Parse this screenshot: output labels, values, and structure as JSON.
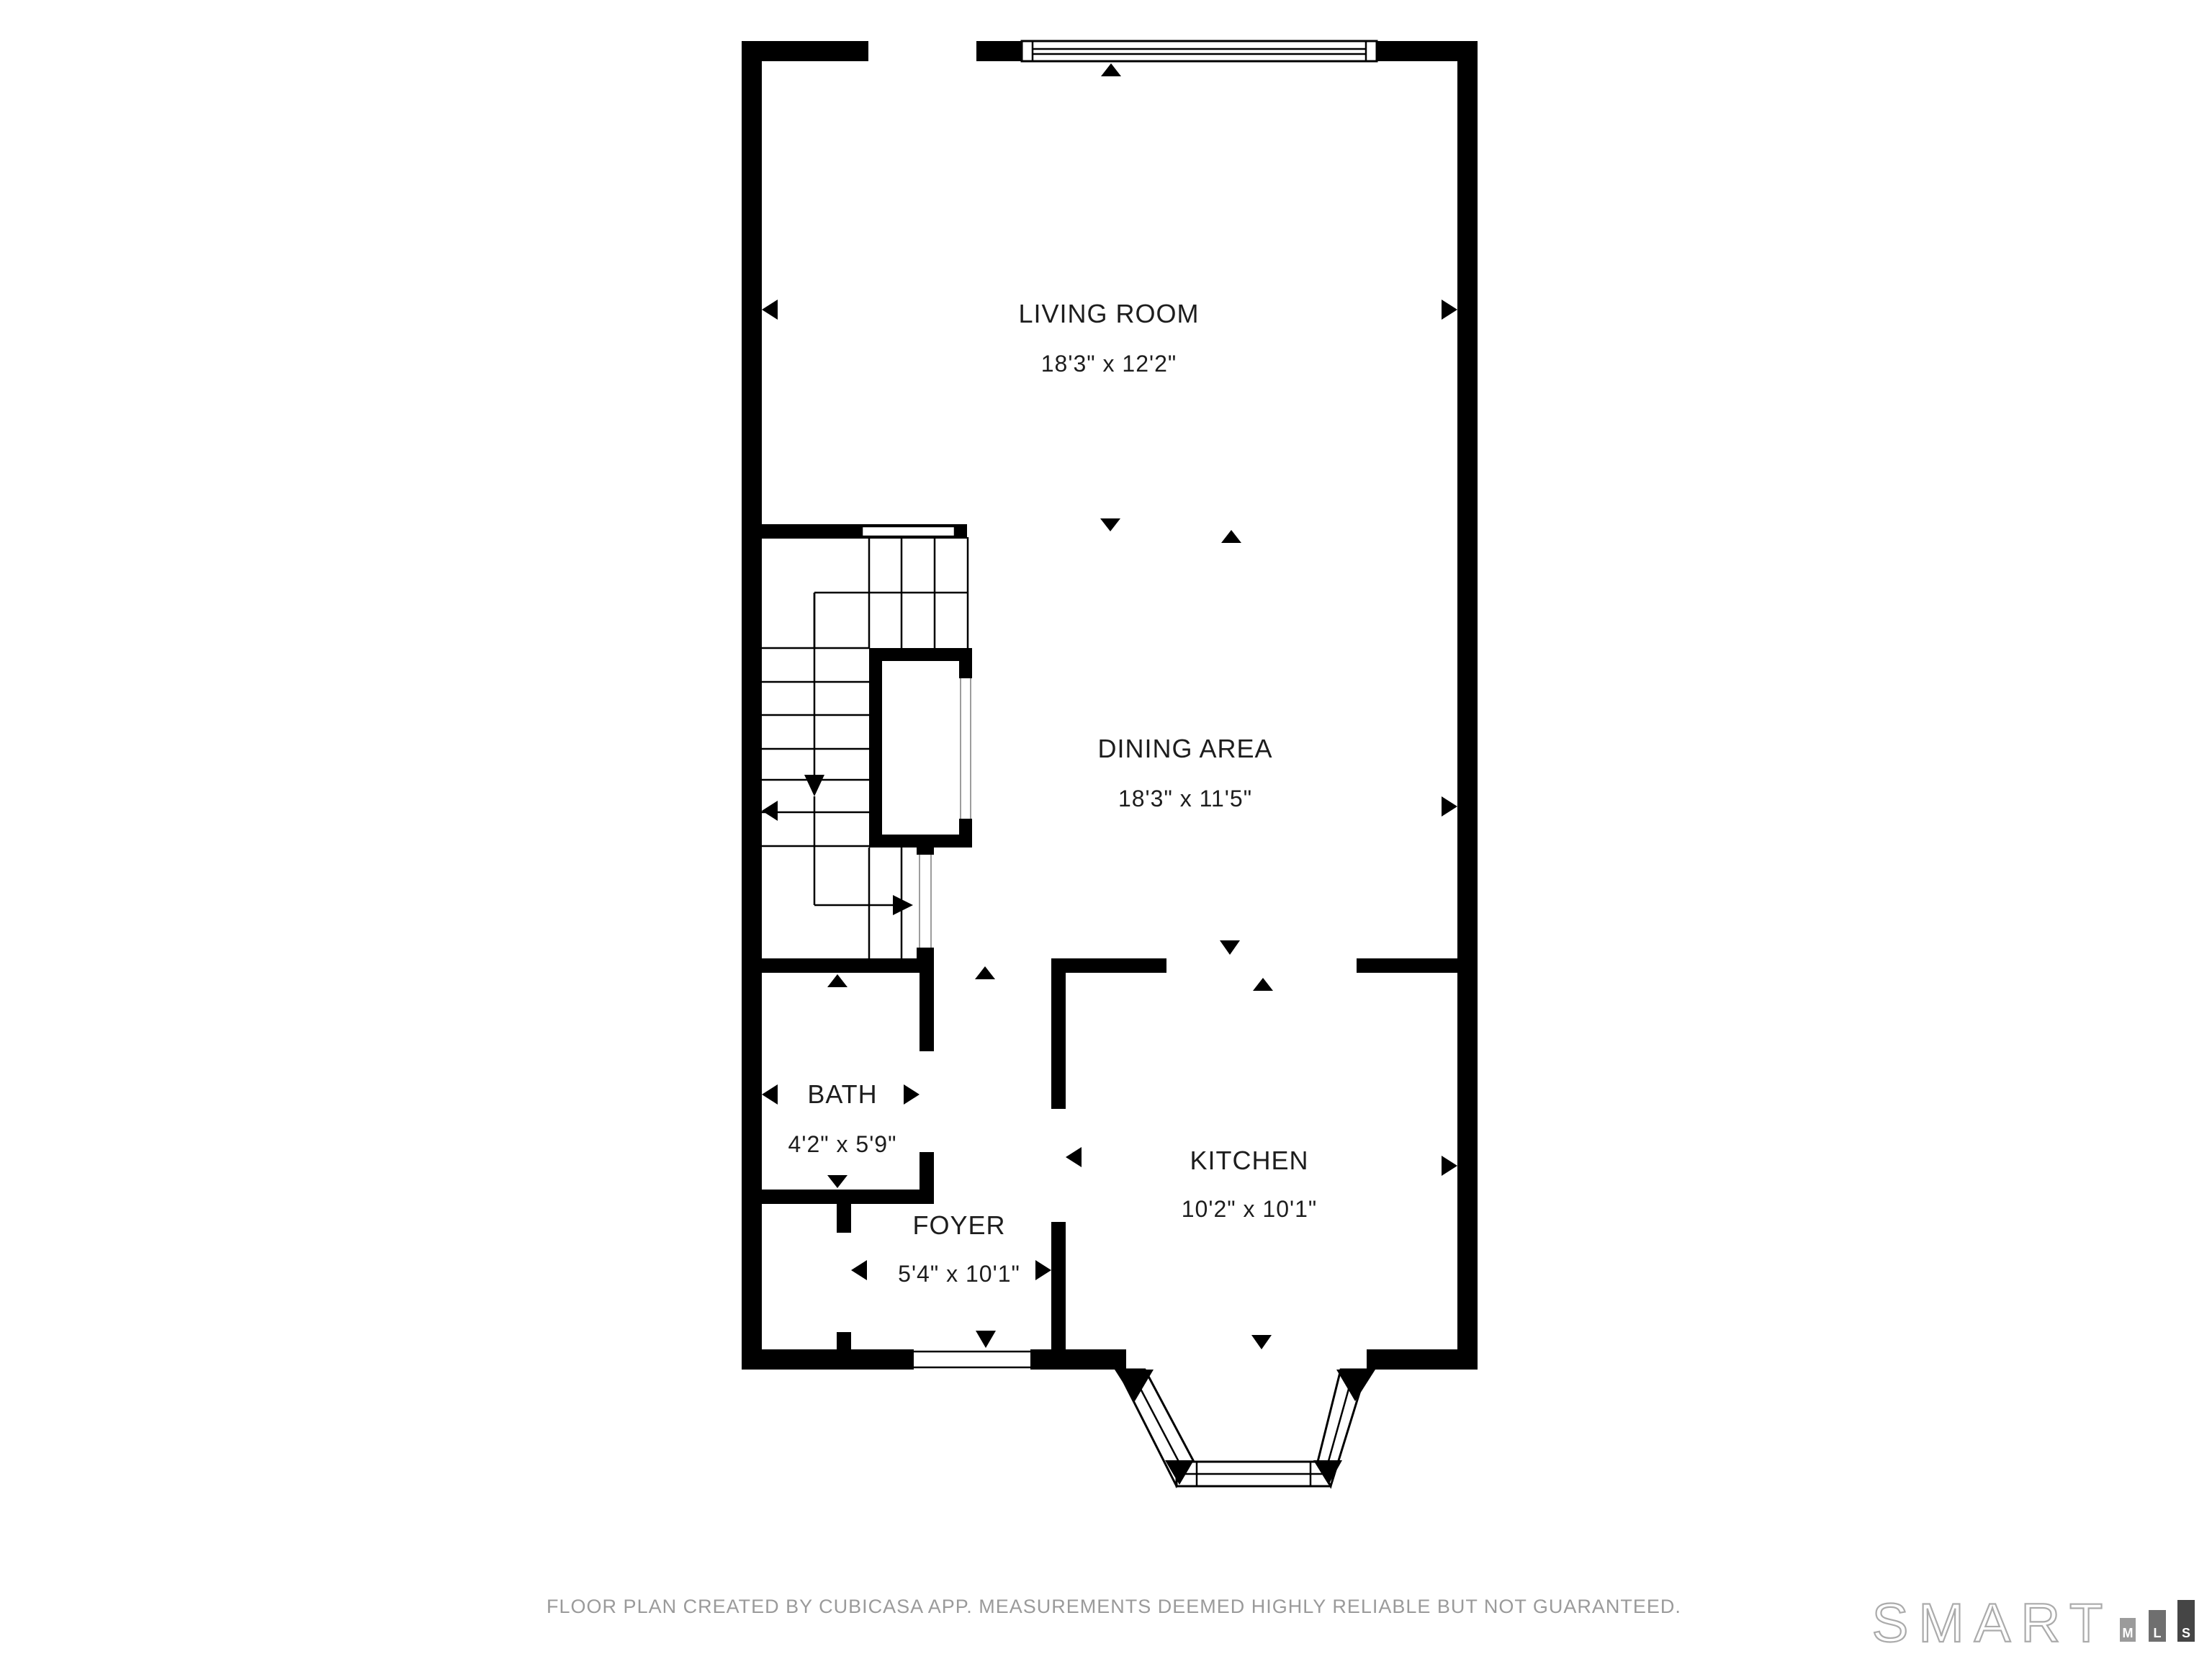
{
  "plan": {
    "wall_color": "#000000",
    "label_color": "#1d1d1d",
    "window_fill": "#ffffff"
  },
  "rooms": [
    {
      "name": "LIVING ROOM",
      "dimensions": "18'3\" x 12'2\""
    },
    {
      "name": "DINING AREA",
      "dimensions": "18'3\" x 11'5\""
    },
    {
      "name": "BATH",
      "dimensions": "4'2\" x 5'9\""
    },
    {
      "name": "FOYER",
      "dimensions": "5'4\" x 10'1\""
    },
    {
      "name": "KITCHEN",
      "dimensions": "10'2\" x 10'1\""
    }
  ],
  "footer": {
    "disclaimer": "FLOOR PLAN CREATED BY CUBICASA APP. MEASUREMENTS DEEMED HIGHLY RELIABLE BUT NOT GUARANTEED.",
    "color": "#9a9a9a"
  },
  "branding": {
    "wordmark": "SMART",
    "wordmark_color": "#ababab",
    "bar_label_color": "#ffffff",
    "bars": [
      {
        "label": "M",
        "color": "#9b9b9b"
      },
      {
        "label": "L",
        "color": "#6f6f6f"
      },
      {
        "label": "S",
        "color": "#454545"
      }
    ]
  }
}
